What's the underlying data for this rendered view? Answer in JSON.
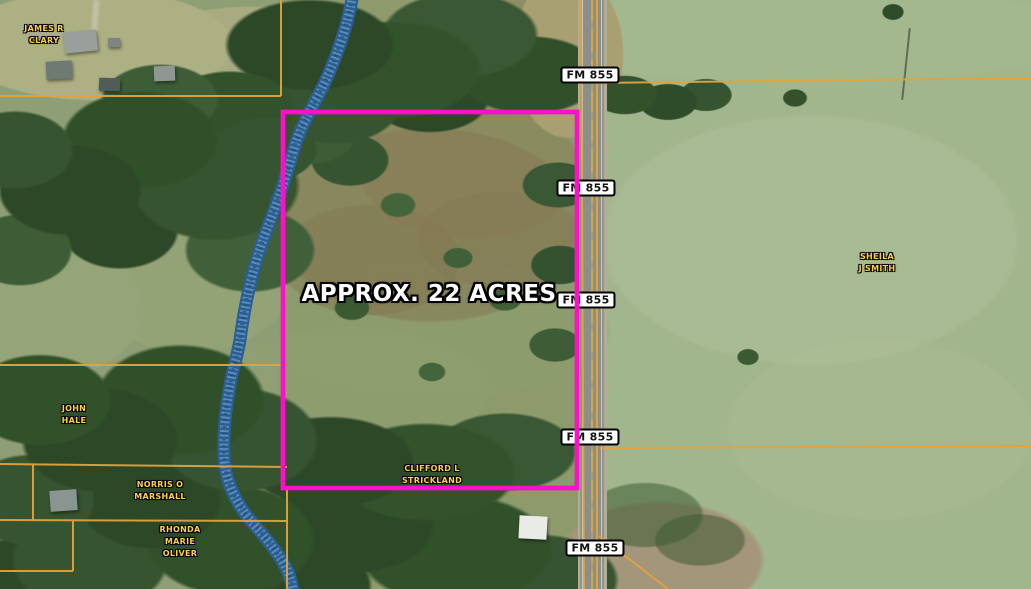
{
  "map": {
    "type": "aerial-parcel-map",
    "road_label": "FM 855",
    "highlighted_parcel": {
      "label": "APPROX. 22 ACRES",
      "outline_color": "#FF10C8"
    },
    "owners": [
      {
        "id": "james-r-clary",
        "lines": [
          "JAMES R",
          "CLARY"
        ]
      },
      {
        "id": "sheila-j-smith",
        "lines": [
          "SHEILA",
          "J SMITH"
        ]
      },
      {
        "id": "john-hale",
        "lines": [
          "JOHN",
          "HALE"
        ]
      },
      {
        "id": "norris-o-marshall",
        "lines": [
          "NORRIS O",
          "MARSHALL"
        ]
      },
      {
        "id": "rhonda-marie-oliver",
        "lines": [
          "RHONDA",
          "MARIE",
          "OLIVER"
        ]
      },
      {
        "id": "clifford-l-strickland",
        "lines": [
          "CLIFFORD L",
          "STRICKLAND"
        ]
      }
    ],
    "colors": {
      "parcel_boundary": "#E2A33C",
      "owner_label_text": "#FFD042",
      "creek": "#2B5F93",
      "road_shield_bg": "#FFFFFF",
      "road_shield_text": "#111111"
    }
  }
}
